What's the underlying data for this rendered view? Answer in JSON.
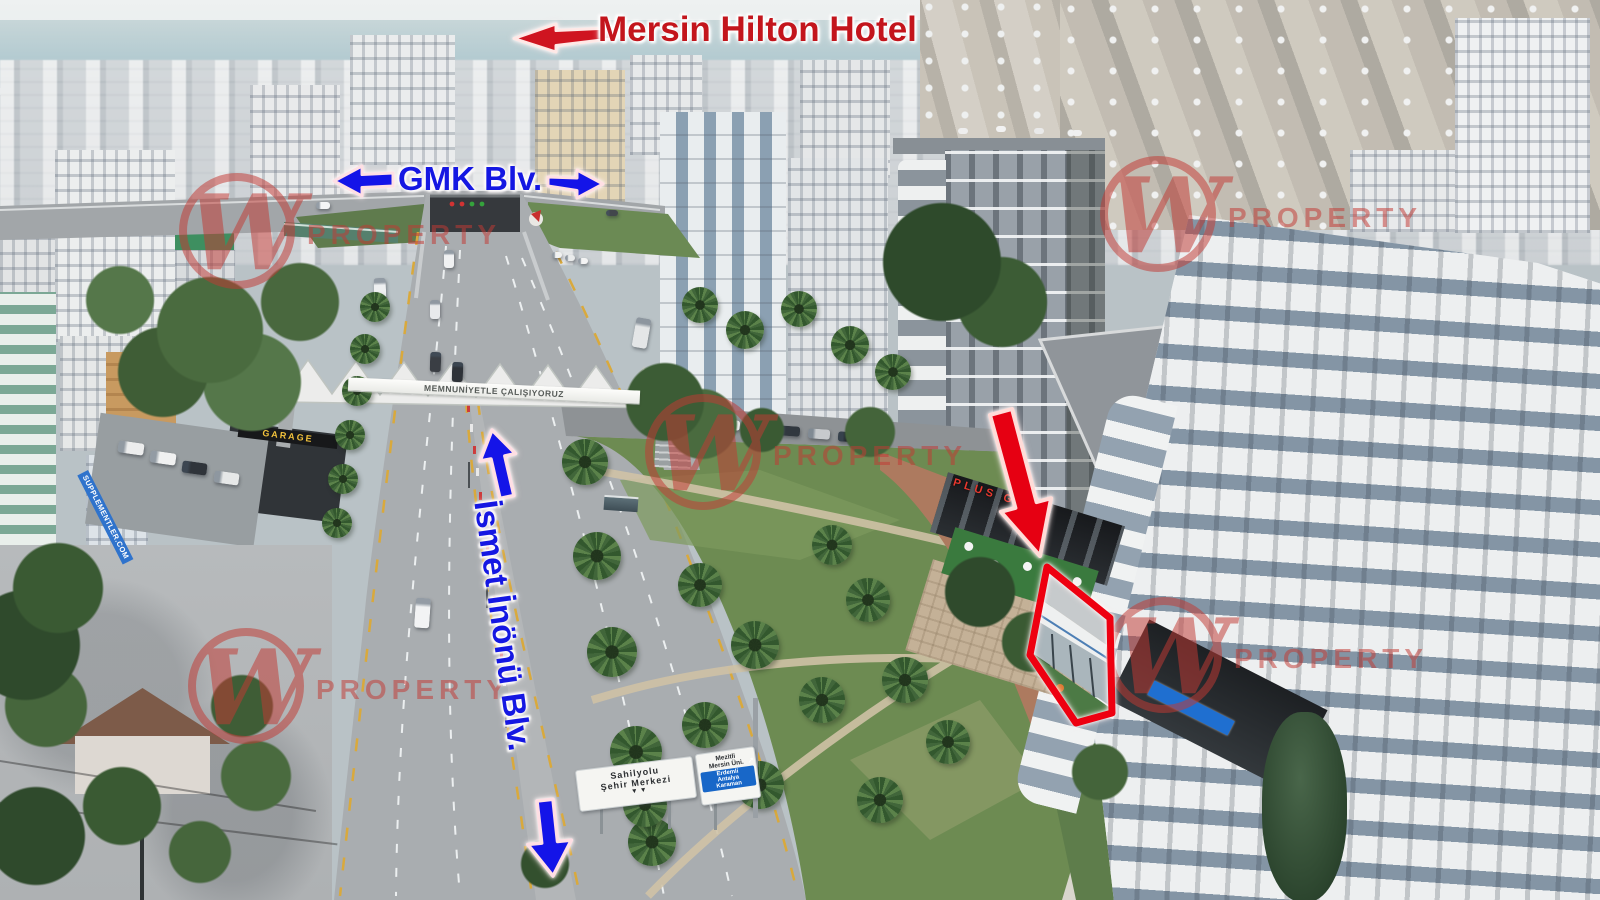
{
  "annotations": {
    "hotel_label": "Mersin Hilton Hotel",
    "gmk_label": "GMK Blv.",
    "ismet_label": "İsmet İnönü Blv."
  },
  "watermark": {
    "letter": "W",
    "text": "PROPERTY",
    "color": "#c23a34"
  },
  "signs": {
    "overpass_banner": "MEMNUNİYETLE ÇALIŞIYORUZ",
    "road_sign_left": {
      "line1": "Sahilyolu",
      "line2": "Şehir Merkezi",
      "arrow_icon": "▾"
    },
    "road_sign_right": {
      "line1": "Mezitli",
      "line2": "Mersin Üni.",
      "blue_lines": [
        "Erdemli",
        "Antalya",
        "Karaman"
      ],
      "arrow_icon": "↗"
    },
    "gym_sign": "PLUS GYM",
    "supplement_sign": "SUPPLEMENTLER.COM",
    "garage_sign": "GARAGE"
  },
  "colors": {
    "annotation_red": "#e60013",
    "annotation_blue": "#1414eb",
    "highlight_outline": "#ee0010",
    "watermark_red": "#c23a34",
    "road_grey": "#a9adb0",
    "park_green": "#6d8b52"
  }
}
